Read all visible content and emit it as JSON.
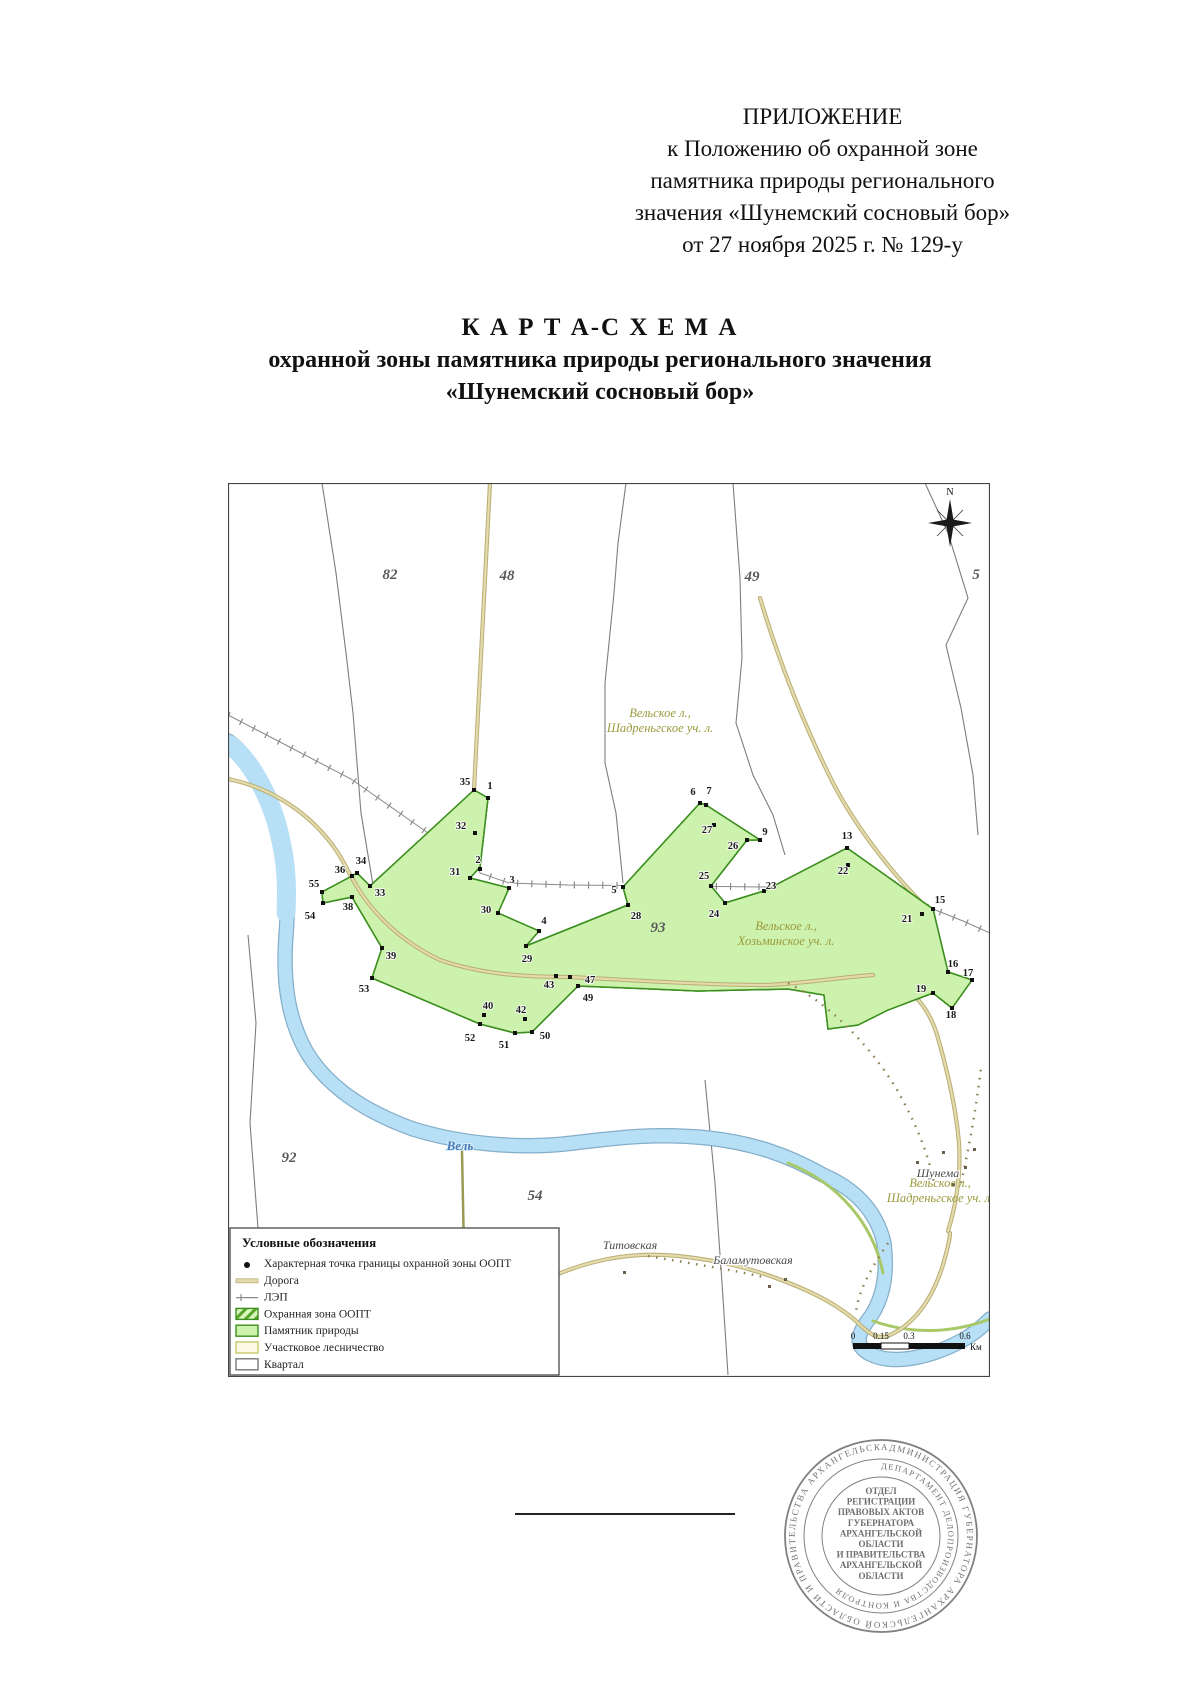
{
  "header": {
    "lines": [
      "ПРИЛОЖЕНИЕ",
      "к Положению об охранной зоне",
      "памятника природы регионального",
      "значения «Шунемский сосновый бор»",
      "от 27 ноября 2025 г. № 129-у"
    ]
  },
  "title": {
    "line1": "К А Р Т А-С Х Е М А",
    "line2": "охранной зоны памятника природы регионального значения",
    "line3": "«Шунемский сосновый бор»"
  },
  "map": {
    "compass_label": "N",
    "quarter_numbers": [
      {
        "t": "8",
        "x": -4,
        "y": 96
      },
      {
        "t": "82",
        "x": 162,
        "y": 96
      },
      {
        "t": "48",
        "x": 279,
        "y": 97
      },
      {
        "t": "49",
        "x": 524,
        "y": 98
      },
      {
        "t": "5",
        "x": 748,
        "y": 96
      },
      {
        "t": "93",
        "x": 430,
        "y": 449
      },
      {
        "t": "92",
        "x": 61,
        "y": 679
      },
      {
        "t": "54",
        "x": 307,
        "y": 717
      }
    ],
    "forestry_labels": [
      {
        "l1": "Вельское л.,",
        "l2": "Шадреньгское уч. л.",
        "x": 432,
        "y": 234
      },
      {
        "l1": "Вельское л.,",
        "l2": "Хозьминское уч. л.",
        "x": 558,
        "y": 447
      },
      {
        "l1": "Вельское л.,",
        "l2": "Шадреньгское уч. л.",
        "x": 712,
        "y": 704
      }
    ],
    "settlements": [
      {
        "t": "Шунема",
        "x": 710,
        "y": 694
      },
      {
        "t": "Титовская",
        "x": 402,
        "y": 766
      },
      {
        "t": "Баламутовская",
        "x": 525,
        "y": 781
      }
    ],
    "river_label": {
      "t": "Вель",
      "x": 232,
      "y": 667
    },
    "points": [
      {
        "n": "35",
        "x": 246,
        "y": 307,
        "lx": 237,
        "ly": 299
      },
      {
        "n": "1",
        "x": 260,
        "y": 315,
        "lx": 262,
        "ly": 303
      },
      {
        "n": "32",
        "x": 247,
        "y": 350,
        "lx": 233,
        "ly": 343
      },
      {
        "n": "2",
        "x": 252,
        "y": 386,
        "lx": 250,
        "ly": 377
      },
      {
        "n": "31",
        "x": 242,
        "y": 395,
        "lx": 227,
        "ly": 389
      },
      {
        "n": "3",
        "x": 281,
        "y": 405,
        "lx": 284,
        "ly": 397
      },
      {
        "n": "30",
        "x": 270,
        "y": 430,
        "lx": 258,
        "ly": 427
      },
      {
        "n": "4",
        "x": 311,
        "y": 448,
        "lx": 316,
        "ly": 438
      },
      {
        "n": "29",
        "x": 298,
        "y": 463,
        "lx": 299,
        "ly": 476
      },
      {
        "n": "34",
        "x": 129,
        "y": 390,
        "lx": 133,
        "ly": 378
      },
      {
        "n": "36",
        "x": 124,
        "y": 393,
        "lx": 112,
        "ly": 387
      },
      {
        "n": "33",
        "x": 142,
        "y": 403,
        "lx": 152,
        "ly": 410
      },
      {
        "n": "55",
        "x": 94,
        "y": 409,
        "lx": 86,
        "ly": 401
      },
      {
        "n": "38",
        "x": 124,
        "y": 414,
        "lx": 120,
        "ly": 424
      },
      {
        "n": "54",
        "x": 95,
        "y": 420,
        "lx": 82,
        "ly": 433
      },
      {
        "n": "39",
        "x": 154,
        "y": 465,
        "lx": 163,
        "ly": 473
      },
      {
        "n": "53",
        "x": 144,
        "y": 495,
        "lx": 136,
        "ly": 506
      },
      {
        "n": "40",
        "x": 256,
        "y": 532,
        "lx": 260,
        "ly": 523
      },
      {
        "n": "42",
        "x": 297,
        "y": 536,
        "lx": 293,
        "ly": 527
      },
      {
        "n": "52",
        "x": 252,
        "y": 541,
        "lx": 242,
        "ly": 555
      },
      {
        "n": "51",
        "x": 287,
        "y": 550,
        "lx": 276,
        "ly": 562
      },
      {
        "n": "50",
        "x": 304,
        "y": 549,
        "lx": 317,
        "ly": 553
      },
      {
        "n": "43",
        "x": 328,
        "y": 493,
        "lx": 321,
        "ly": 502
      },
      {
        "n": "47",
        "x": 342,
        "y": 494,
        "lx": 362,
        "ly": 497
      },
      {
        "n": "49",
        "x": 350,
        "y": 503,
        "lx": 360,
        "ly": 515
      },
      {
        "n": "5",
        "x": 395,
        "y": 404,
        "lx": 386,
        "ly": 407
      },
      {
        "n": "28",
        "x": 400,
        "y": 422,
        "lx": 408,
        "ly": 433
      },
      {
        "n": "6",
        "x": 472,
        "y": 320,
        "lx": 465,
        "ly": 309
      },
      {
        "n": "7",
        "x": 478,
        "y": 322,
        "lx": 481,
        "ly": 308
      },
      {
        "n": "27",
        "x": 486,
        "y": 342,
        "lx": 479,
        "ly": 347
      },
      {
        "n": "26",
        "x": 519,
        "y": 357,
        "lx": 505,
        "ly": 363
      },
      {
        "n": "9",
        "x": 532,
        "y": 357,
        "lx": 537,
        "ly": 349
      },
      {
        "n": "25",
        "x": 483,
        "y": 403,
        "lx": 476,
        "ly": 393
      },
      {
        "n": "23",
        "x": 536,
        "y": 408,
        "lx": 543,
        "ly": 403
      },
      {
        "n": "24",
        "x": 497,
        "y": 420,
        "lx": 486,
        "ly": 431
      },
      {
        "n": "13",
        "x": 619,
        "y": 365,
        "lx": 619,
        "ly": 353
      },
      {
        "n": "22",
        "x": 620,
        "y": 382,
        "lx": 615,
        "ly": 388
      },
      {
        "n": "15",
        "x": 705,
        "y": 426,
        "lx": 712,
        "ly": 417
      },
      {
        "n": "21",
        "x": 694,
        "y": 431,
        "lx": 679,
        "ly": 436
      },
      {
        "n": "16",
        "x": 720,
        "y": 489,
        "lx": 725,
        "ly": 481
      },
      {
        "n": "17",
        "x": 744,
        "y": 497,
        "lx": 740,
        "ly": 490
      },
      {
        "n": "19",
        "x": 705,
        "y": 510,
        "lx": 693,
        "ly": 506
      },
      {
        "n": "18",
        "x": 724,
        "y": 525,
        "lx": 723,
        "ly": 532
      }
    ],
    "legend": {
      "title": "Условные обозначения",
      "items": [
        {
          "type": "point",
          "label": "Характерная точка границы охранной зоны ООПТ"
        },
        {
          "type": "road",
          "label": "Дорога"
        },
        {
          "type": "lep",
          "label": "ЛЭП"
        },
        {
          "type": "buffer",
          "label": "Охранная зона ООПТ"
        },
        {
          "type": "monument",
          "label": "Памятник природы"
        },
        {
          "type": "forestry",
          "label": "Участковое лесничество"
        },
        {
          "type": "quarter",
          "label": "Квартал"
        }
      ]
    },
    "scalebar": {
      "labels": [
        "0",
        "0.15",
        "0.3",
        "0.6"
      ],
      "unit": "Км"
    }
  },
  "stamp": {
    "outer_ring": "АДМИНИСТРАЦИЯ ГУБЕРНАТОРА АРХАНГЕЛЬСКОЙ ОБЛАСТИ И ПРАВИТЕЛЬСТВА АРХАНГЕЛЬСКОЙ ОБЛАСТИ",
    "inner_ring": "ДЕПАРТАМЕНТ ДЕЛОПРОИЗВОДСТВА И КОНТРОЛЯ",
    "center_lines": [
      "ОТДЕЛ",
      "РЕГИСТРАЦИИ",
      "ПРАВОВЫХ АКТОВ",
      "ГУБЕРНАТОРА",
      "АРХАНГЕЛЬСКОЙ",
      "ОБЛАСТИ",
      "И ПРАВИТЕЛЬСТВА",
      "АРХАНГЕЛЬСКОЙ",
      "ОБЛАСТИ"
    ]
  },
  "colors": {
    "monument_green": "#cdf2ad",
    "band_dark_green": "#3c8f1e",
    "hatch_stripe": "#56a52c",
    "hatch_bg": "#d9f6bb",
    "river_blue": "#b7e0f6",
    "road_tan": "#e3dbae",
    "road_edge": "#b9ae72",
    "forestry_label_olive": "#9a9a3d",
    "quarter_line_gray": "#7d7d7d",
    "river_label_blue": "#4878b8"
  }
}
